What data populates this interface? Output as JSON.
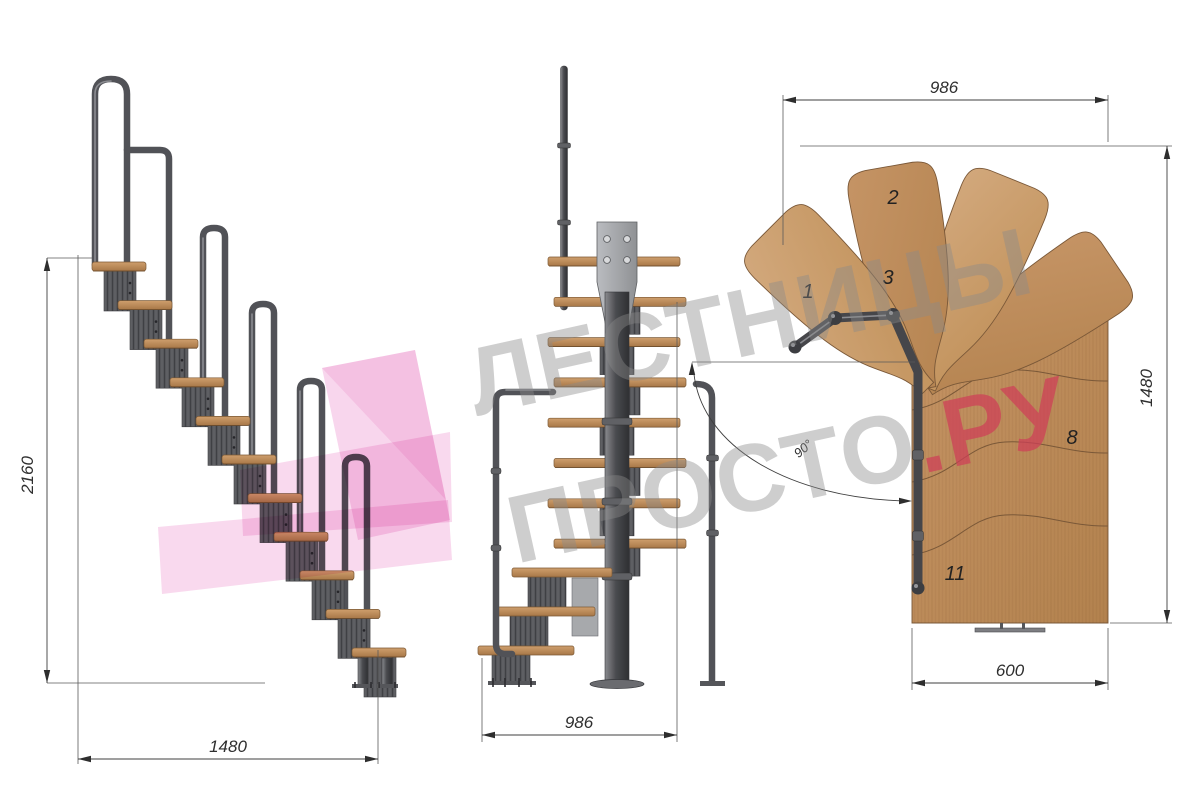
{
  "watermark": {
    "line1": "ЛЕСТНИЦЫ",
    "line2_gray": "ПРОСТО",
    "line2_red": ".РУ"
  },
  "colors": {
    "background": "#ffffff",
    "wood": "#c09468",
    "metal_dark": "#4c4d51",
    "plate_gray": "#a2a4a7",
    "dimension_lines": "#3f3f3f",
    "watermark_gray": "#8a8a8a",
    "watermark_red": "#ce3f57",
    "logo_pink": "#f3b4de"
  },
  "views": {
    "side_elevation": {
      "dim_height": "2160",
      "dim_width": "1480"
    },
    "front_elevation": {
      "dim_width": "986"
    },
    "plan": {
      "dim_top": "986",
      "dim_right": "1480",
      "dim_bottom": "600",
      "angle": "90°",
      "tread_labels": {
        "t1": "1",
        "t2": "2",
        "t3": "3",
        "t8": "8",
        "t11": "11"
      }
    }
  }
}
